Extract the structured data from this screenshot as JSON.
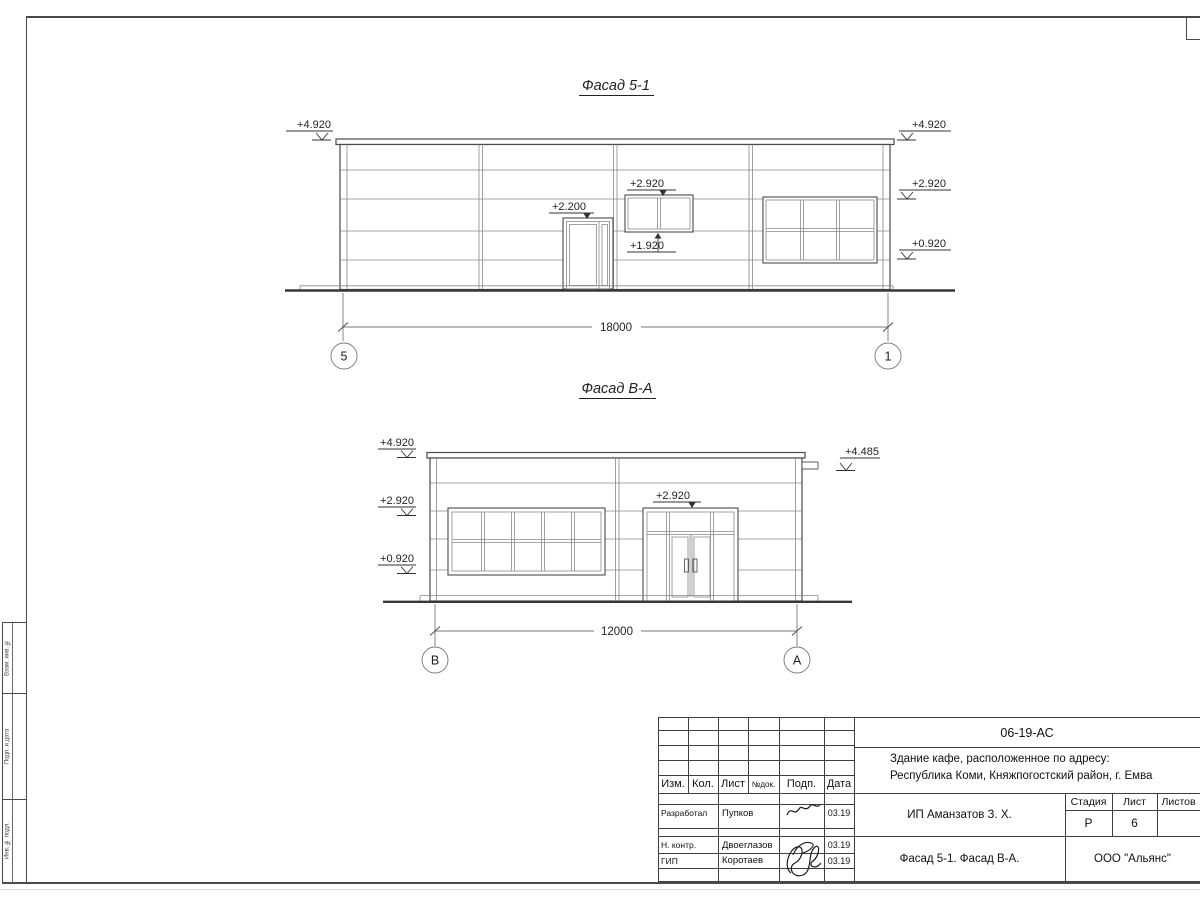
{
  "frame": {
    "left_strip": [
      {
        "label": "Взам. инв. №"
      },
      {
        "label": "Подп. и дата"
      },
      {
        "label": "Инв. № подл."
      }
    ]
  },
  "facade1": {
    "title": "Фасад 5-1",
    "dim": "18000",
    "axis_left": "5",
    "axis_right": "1",
    "marks": {
      "left_roof": "+4.920",
      "right_roof": "+4.920",
      "right_mid": "+2.920",
      "right_low": "+0.920",
      "door": "+2.200",
      "window_top": "+2.920",
      "window_bottom": "+1.920"
    }
  },
  "facade2": {
    "title": "Фасад В-А",
    "dim": "12000",
    "axis_left": "В",
    "axis_right": "А",
    "marks": {
      "left_roof": "+4.920",
      "left_mid": "+2.920",
      "left_low": "+0.920",
      "right_vent": "+4.485",
      "entrance": "+2.920"
    }
  },
  "titleblock": {
    "doc_code": "06-19-АС",
    "object_line1": "Здание кафе, расположенное по адресу:",
    "object_line2": "Республика Коми, Княжпогостский район, г. Емва",
    "client": "ИП Аманзатов З. Х.",
    "sheet_title": "Фасад 5-1. Фасад В-А.",
    "company": "ООО \"Альянс\"",
    "headers": {
      "izm": "Изм.",
      "kol": "Кол.",
      "list": "Лист",
      "ndok": "№док.",
      "podp": "Подп.",
      "data": "Дата"
    },
    "stage": {
      "stadia_label": "Стадия",
      "list_label": "Лист",
      "listov_label": "Листов",
      "stadia": "Р",
      "list": "6",
      "listov": ""
    },
    "rows": [
      {
        "role": "Разработал",
        "name": "Пупков",
        "date": "03.19"
      },
      {
        "role": "Н. контр.",
        "name": "Двоеглазов",
        "date": "03.19"
      },
      {
        "role": "ГИП",
        "name": "Коротаев",
        "date": "03.19"
      }
    ]
  },
  "colors": {
    "line_main": "#4a4a4a",
    "line_thin": "#8a8a8a",
    "dim_text": "#9e9e9e",
    "text": "#1f1f1f"
  }
}
